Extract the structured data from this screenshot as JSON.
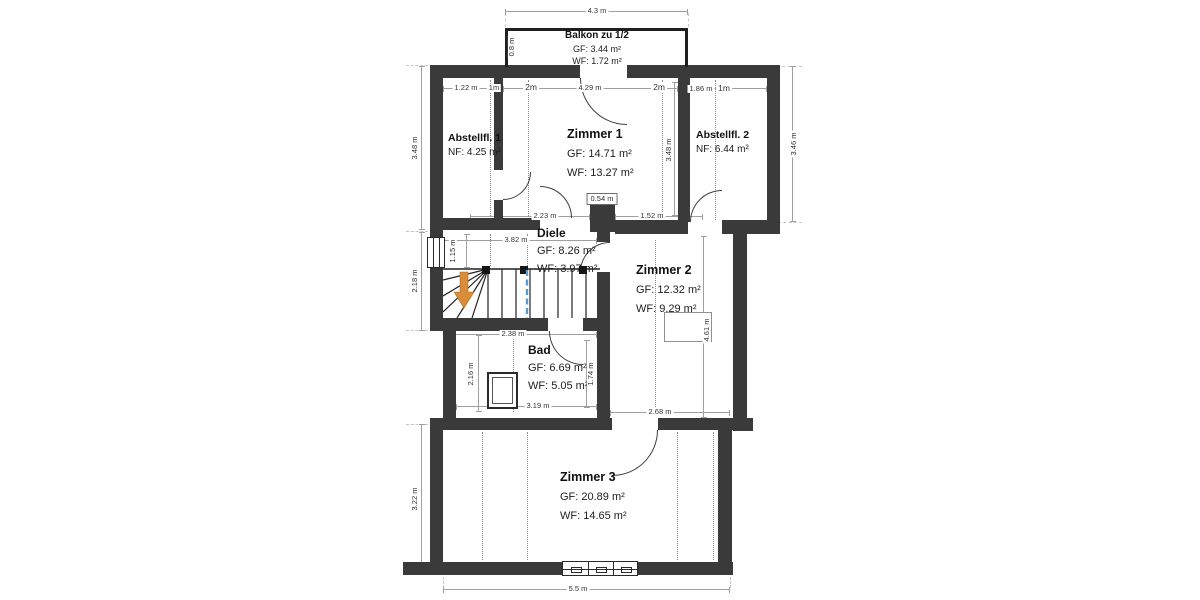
{
  "rooms": {
    "balkon": {
      "name": "Balkon zu 1/2",
      "gf": "GF: 3.44 m²",
      "wf": "WF: 1.72 m²"
    },
    "abstellfl1": {
      "name": "Abstellfl. 1",
      "nf": "NF: 4.25 m²"
    },
    "zimmer1": {
      "name": "Zimmer 1",
      "gf": "GF: 14.71 m²",
      "wf": "WF: 13.27 m²"
    },
    "abstellfl2": {
      "name": "Abstellfl. 2",
      "nf": "NF: 6.44 m²"
    },
    "diele": {
      "name": "Diele",
      "gf": "GF: 8.26 m²",
      "wf": "WF: 3.97 m²"
    },
    "zimmer2": {
      "name": "Zimmer 2",
      "gf": "GF: 12.32 m²",
      "wf": "WF: 9.29 m²"
    },
    "bad": {
      "name": "Bad",
      "gf": "GF: 6.69 m²",
      "wf": "WF: 5.05 m²"
    },
    "zimmer3": {
      "name": "Zimmer 3",
      "gf": "GF: 20.89 m²",
      "wf": "WF: 14.65 m²"
    }
  },
  "dims": {
    "balcony_width": "4.3 m",
    "balcony_depth": "0.8 m",
    "abst1_w1": "1.22 m",
    "abst1_w2": "1m",
    "z1_h1": "2m",
    "z1_w": "4.29 m",
    "z1_h2": "2m",
    "abst2_w1": "1.86 m",
    "abst2_w2": "1m",
    "left_upper": "3.48 m",
    "z1_depth": "3.48 m",
    "right_upper": "3.46 m",
    "z1_b1": "2.23 m",
    "pillar": "0.54 m",
    "z1_b2": "1.52 m",
    "diele_w": "3.82 m",
    "stair_w": "1.15 m",
    "left_mid": "2.18 m",
    "bad_top": "2.38 m",
    "bad_left": "2.16 m",
    "bad_right": "1.74 m",
    "bad_bottom": "3.19 m",
    "z2_bottom": "2.68 m",
    "z2_right": "4.61 m",
    "left_lower": "3.22 m",
    "bottom_width": "5.5 m"
  },
  "colors": {
    "wall": "#3a3a3a",
    "stairs_arrow": "#d98c3a",
    "section_cut_line": "#5b9bd5"
  }
}
